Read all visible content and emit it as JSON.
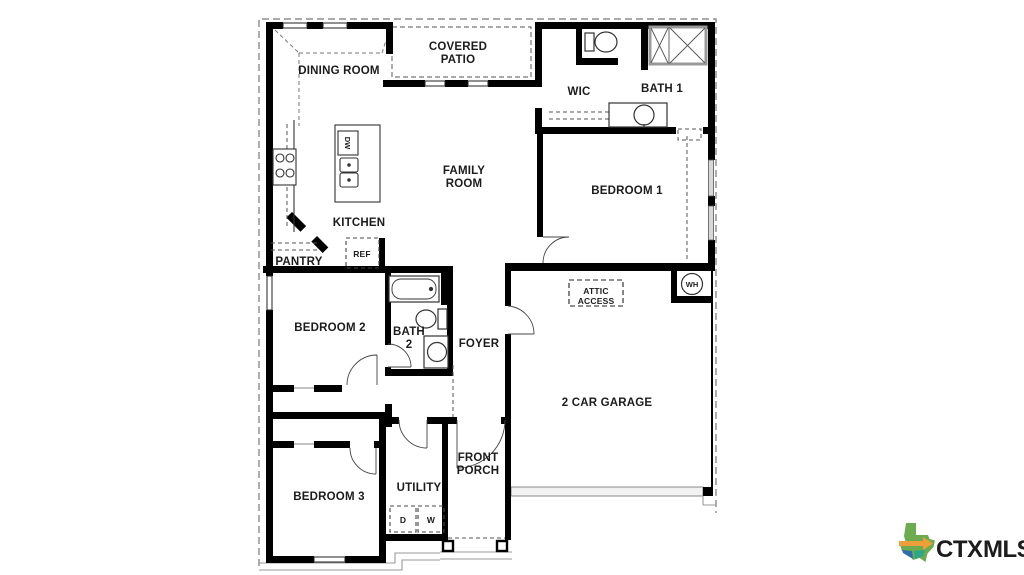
{
  "plan": {
    "labels": {
      "dining_room": "DINING ROOM",
      "covered_patio": [
        "COVERED",
        "PATIO"
      ],
      "wic": "WIC",
      "bath_1": "BATH 1",
      "family_room": [
        "FAMILY",
        "ROOM"
      ],
      "bedroom_1": "BEDROOM 1",
      "kitchen": "KITCHEN",
      "pantry": "PANTRY",
      "bedroom_2": "BEDROOM 2",
      "bath_2": [
        "BATH",
        "2"
      ],
      "foyer": "FOYER",
      "garage": "2 CAR GARAGE",
      "bedroom_3": "BEDROOM 3",
      "utility": "UTILITY",
      "front_porch": [
        "FRONT",
        "PORCH"
      ],
      "attic_access": [
        "ATTIC",
        "ACCESS"
      ]
    },
    "appliances": {
      "refrigerator": "REF",
      "dishwasher": "DW",
      "water_heater": "WH",
      "dryer": "D",
      "washer": "W"
    }
  },
  "logo": {
    "ctx": "CTX",
    "mls": "MLS",
    "ctx_color": "#F2A33C",
    "mls_color": "#26639B",
    "texas_green": "#6CAB50",
    "texas_blue": "#2D6FAD",
    "texas_teal": "#2FA58A",
    "arrow_orange": "#EF9F3A"
  },
  "colors": {
    "walls": "#000000",
    "background": "#FFFFFF"
  }
}
